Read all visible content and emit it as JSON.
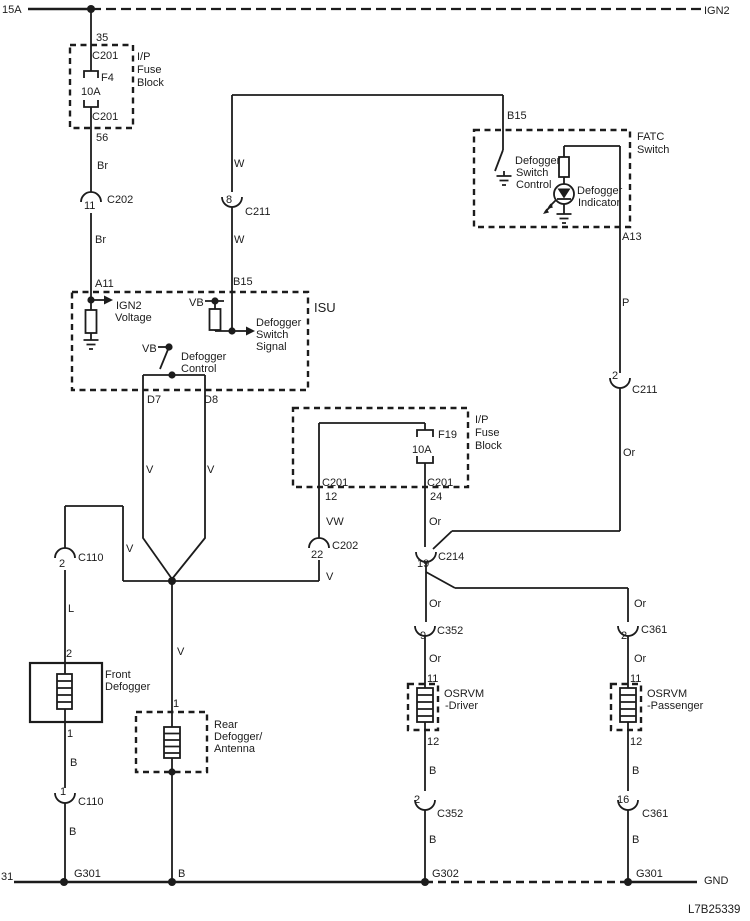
{
  "drawing_id": "L7B25339",
  "rails": {
    "top": {
      "left": "15A",
      "right": "IGN2"
    },
    "bottom": {
      "left": "31",
      "right": "GND"
    }
  },
  "fuse_block_f4": {
    "name": [
      "I/P",
      "Fuse",
      "Block"
    ],
    "pin_top": "35",
    "conn_top": "C201",
    "fuse_id": "F4",
    "rating": "10A",
    "conn_bottom": "C201",
    "pin_bottom": "56"
  },
  "left_feed": {
    "wire_color_1": "Br",
    "conn": {
      "pin": "11",
      "name": "C202"
    },
    "wire_color_2": "Br",
    "pin_isu": "A11"
  },
  "isu": {
    "name": "ISU",
    "ign2_voltage": [
      "IGN2",
      "Voltage"
    ],
    "vb_pullup": "VB",
    "switch_signal": [
      "Defogger",
      "Switch",
      "Signal"
    ],
    "vb_control": "VB",
    "control": [
      "Defogger",
      "Control"
    ],
    "pin_b15": "B15",
    "pin_d7": "D7",
    "pin_d8": "D8"
  },
  "signal_wire": {
    "color_top": "W",
    "conn": {
      "pin": "8",
      "name": "C211"
    },
    "color_bottom": "W"
  },
  "fatc": {
    "name": [
      "FATC",
      "Switch"
    ],
    "pin_b15": "B15",
    "switch_control": [
      "Defogger",
      "Switch",
      "Control"
    ],
    "indicator": [
      "Defogger",
      "Indicator"
    ],
    "pin_a13": "A13",
    "wire_color_1": "P",
    "conn": {
      "pin": "2",
      "name": "C211"
    },
    "wire_color_2": "Or"
  },
  "fuse_block_f19": {
    "name": [
      "I/P",
      "Fuse",
      "Block"
    ],
    "fuse_id": "F19",
    "rating": "10A",
    "conn_left": "C201",
    "pin_left": "12",
    "conn_right": "C201",
    "pin_right": "24",
    "wire_vw": "VW",
    "conn_vw": {
      "pin": "22",
      "name": "C202"
    },
    "wire_v": "V",
    "wire_or": "Or",
    "conn_or": {
      "pin": "19",
      "name": "C214"
    }
  },
  "defogger_outputs": {
    "wire_d7": "V",
    "wire_d8": "V",
    "front_tap": "V",
    "rear_wire": "V"
  },
  "front_defogger": {
    "conn_top": {
      "pin": "2",
      "name": "C110"
    },
    "wire_color": "L",
    "pin_top": "2",
    "name": [
      "Front",
      "Defogger"
    ],
    "pin_bottom": "1",
    "wire_b1": "B",
    "conn_bottom": {
      "pin": "1",
      "name": "C110"
    },
    "wire_b2": "B",
    "ground": "G301"
  },
  "rear_defogger": {
    "pin_top": "1",
    "name": [
      "Rear",
      "Defogger/",
      "Antenna"
    ],
    "wire_b": "B"
  },
  "osrvm_driver": {
    "wire_or1": "Or",
    "conn_top": {
      "pin": "9",
      "name": "C352"
    },
    "wire_or2": "Or",
    "pin_top": "11",
    "name": [
      "OSRVM",
      "-Driver"
    ],
    "pin_bottom": "12",
    "wire_b1": "B",
    "conn_bottom": {
      "pin": "2",
      "name": "C352"
    },
    "wire_b2": "B",
    "ground": "G302"
  },
  "osrvm_passenger": {
    "wire_or1": "Or",
    "conn_top": {
      "pin": "2",
      "name": "C361"
    },
    "wire_or2": "Or",
    "pin_top": "11",
    "name": [
      "OSRVM",
      "-Passenger"
    ],
    "pin_bottom": "12",
    "wire_b1": "B",
    "conn_bottom": {
      "pin": "16",
      "name": "C361"
    },
    "wire_b2": "B",
    "ground": "G301"
  }
}
